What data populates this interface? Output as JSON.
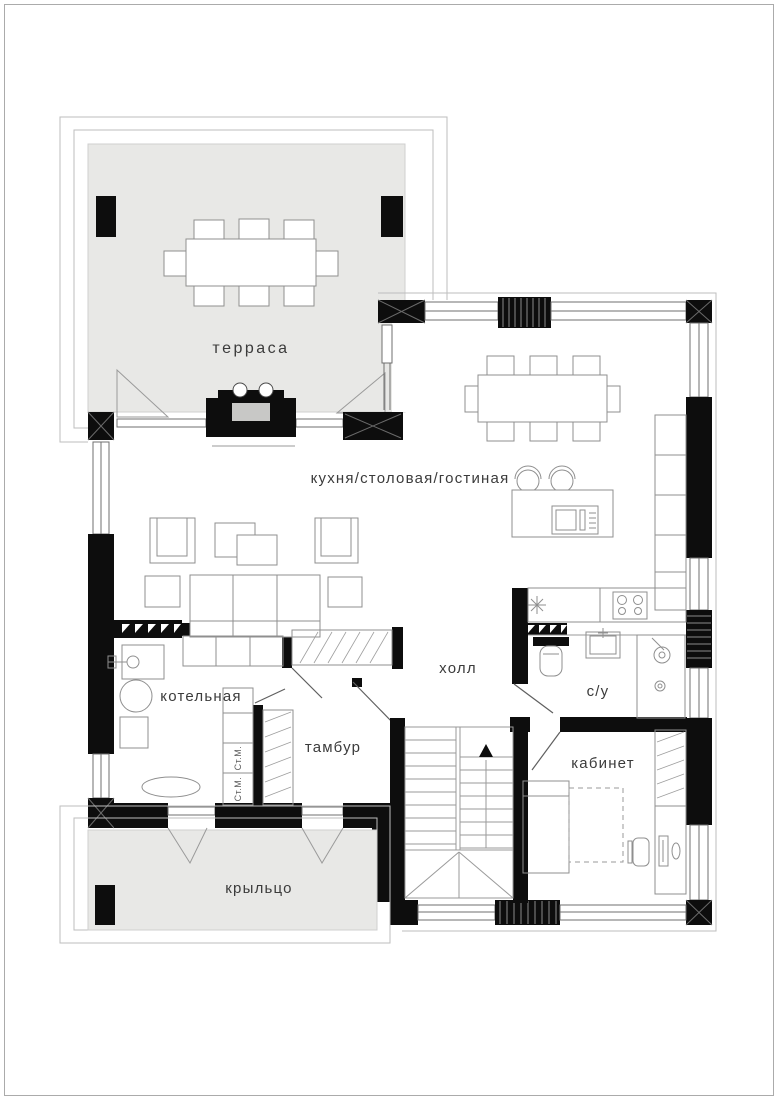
{
  "drawing": {
    "type": "floor-plan",
    "background": "#ffffff"
  },
  "colors": {
    "wall": "#0d0d0d",
    "deck_gray": "#e8e8e6",
    "firebox_gray": "#c8c8c6",
    "outline_gray": "#9a9a9a",
    "label_gray": "#3b3b3b"
  },
  "rooms": {
    "terrace": "терраса",
    "kitchen_dining_living": "кухня/столовая/гостиная",
    "hall": "холл",
    "boiler_room": "котельная",
    "vestibule": "тамбур",
    "bathroom": "с/у",
    "study": "кабинет",
    "porch": "крыльцо"
  },
  "labels": {
    "washing_machine_1": "Ст.М.",
    "washing_machine_2": "Ст.М."
  }
}
